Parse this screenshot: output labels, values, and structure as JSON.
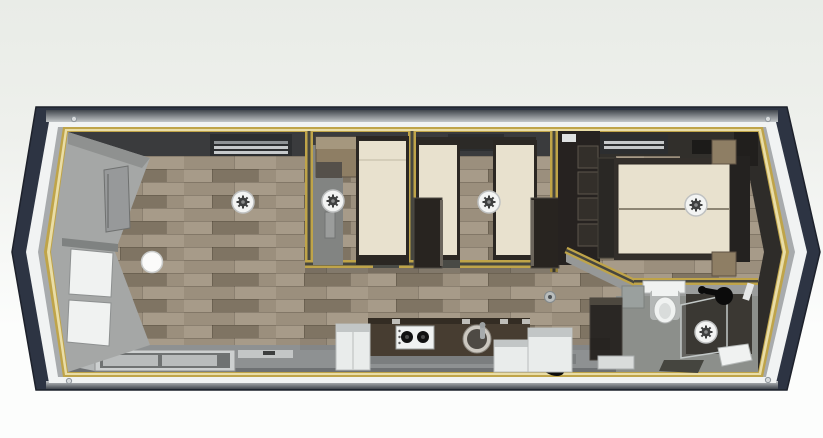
{
  "meta": {
    "title": "Top-down 3D floor plan render of a single-wide mobile home with pointed bay ends",
    "view": "top-down 3D render",
    "scene": "floor-plan"
  },
  "colors": {
    "background_top": "#e9ece7",
    "background_bottom": "#fcfdfc",
    "hull_navy": "#2d3443",
    "hull_line": "#1d212b",
    "roof_dark": "#41464d",
    "roof_light": "#c2c6c8",
    "band_white": "#f1f3f3",
    "band_gray": "#a8abad",
    "trim_gold": "#bfa449",
    "trim_gold_light": "#e9dda7",
    "floor_wood_1": "#9b8f7d",
    "floor_wood_2": "#8a7e6c",
    "floor_wood_3": "#a79b89",
    "floor_wood_4": "#7f7463",
    "wall_gray": "#a5a7a6",
    "interior_dark": "#3a3b3d",
    "master_dark": "#312f2b",
    "bed_cream": "#e8e1ce",
    "bed_frame": "#2b2723",
    "wardrobe_dark": "#282420",
    "cabinet_tan": "#8e7e64",
    "cabinet_tan_light": "#a5977e",
    "counter_dark": "#473d31",
    "counter_edge": "#332c23",
    "cabinet_white": "#e9eceb",
    "cabinet_white_top": "#c2c6c6",
    "bathroom_floor": "#8c8f8b",
    "fixture_white": "#f0f2f1",
    "glass_tint": "rgba(58,56,52,0.5)",
    "glass_edge": "#c2c8c7",
    "light_disc": "#f3f4f3",
    "light_ring": "#bfc1c1",
    "light_gear": "#3e3f3f",
    "black": "#0b0b0b"
  },
  "building": {
    "shape": "elongated hexagon (pointed bay at both ends)",
    "shell": "navy outer frame with white band and gold wall-plate trim",
    "flooring": "gray-brown wood planks"
  },
  "rooms": [
    {
      "id": "living-area",
      "label": "Living area",
      "furniture": [
        "bay-window-panes",
        "wall-tv",
        "round-table",
        "ceiling-light",
        "ac-vent",
        "sliding-window"
      ]
    },
    {
      "id": "kitchen",
      "label": "Kitchen",
      "furniture": [
        "dark-countertop",
        "gas-hob-2-burner",
        "round-sink",
        "faucet",
        "white-base-cabinets",
        "tall-dark-cabinet"
      ]
    },
    {
      "id": "bedroom-1",
      "label": "Bedroom 1",
      "furniture": [
        "double-bed",
        "tan-wardrobe",
        "wall-shelf",
        "ceiling-light"
      ]
    },
    {
      "id": "bedroom-2",
      "label": "Bedroom 2 (twin)",
      "furniture": [
        "single-bed-left",
        "single-bed-right",
        "wardrobe-left",
        "wardrobe-right",
        "ceiling-light",
        "ac-vent"
      ]
    },
    {
      "id": "master-bedroom",
      "label": "Master bedroom",
      "furniture": [
        "double-bed",
        "headboard",
        "nightstand-top",
        "nightstand-bottom",
        "wardrobe-column",
        "open-shelving-unit",
        "ceiling-light",
        "ac-vent"
      ]
    },
    {
      "id": "bathroom",
      "label": "Bathroom",
      "furniture": [
        "toilet",
        "vanity-shelf",
        "shower-enclosure",
        "shower-head",
        "hand-shower",
        "shower-tray",
        "ceiling-light",
        "floor-hatch"
      ]
    },
    {
      "id": "hallway",
      "label": "Hallway / entry",
      "furniture": [
        "downlight",
        "door-mat",
        "black-object"
      ]
    }
  ],
  "lights": {
    "count": 5,
    "style": "round white ceiling lights with dark fan hub"
  }
}
